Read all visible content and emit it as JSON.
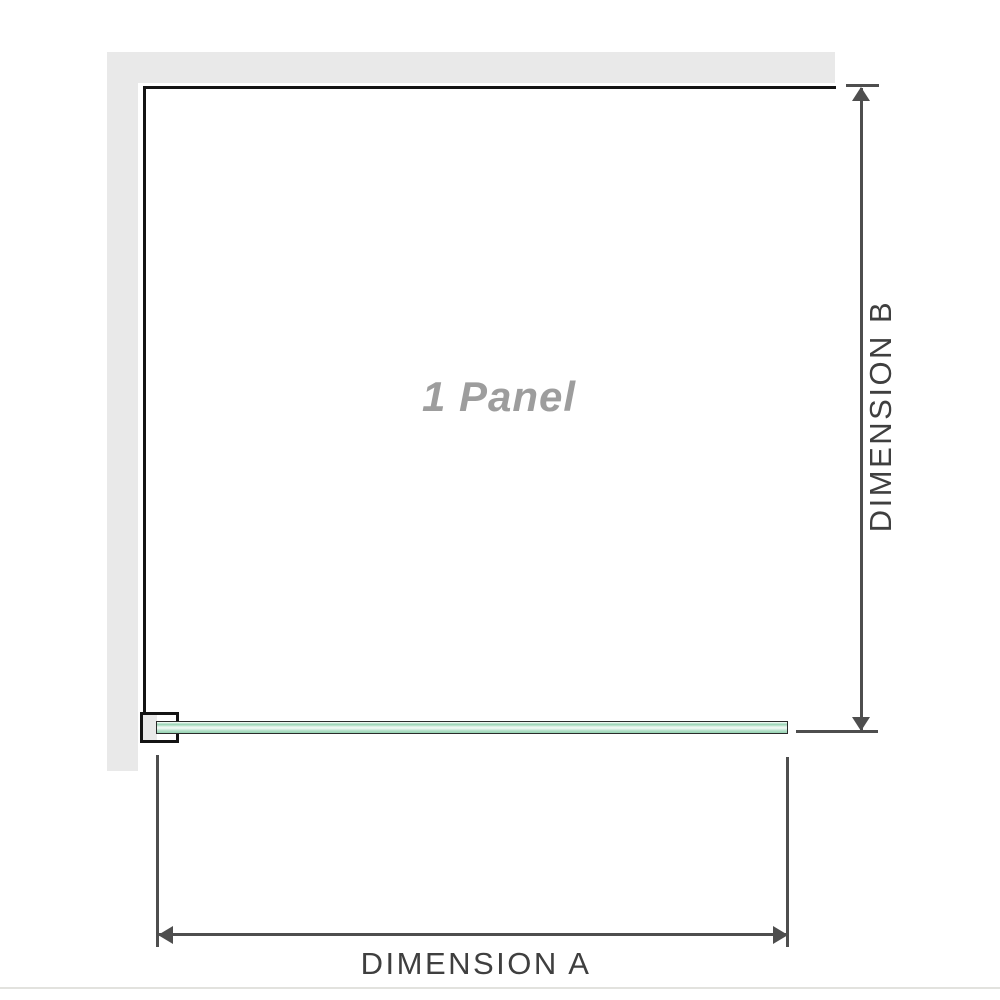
{
  "diagram": {
    "panel_label": "1 Panel",
    "dimension_a_label": "DIMENSION A",
    "dimension_b_label": "DIMENSION B"
  },
  "colors": {
    "wall-gray": "#e9e9e9",
    "outline-black": "#141414",
    "dim-line": "#4e4e4e",
    "dim-text": "#3f3f3f",
    "label-gray": "#9d9d9d",
    "glass-green": "#96d3b2",
    "glass-highlight": "#edf8f2",
    "divider": "#e2e2de"
  }
}
